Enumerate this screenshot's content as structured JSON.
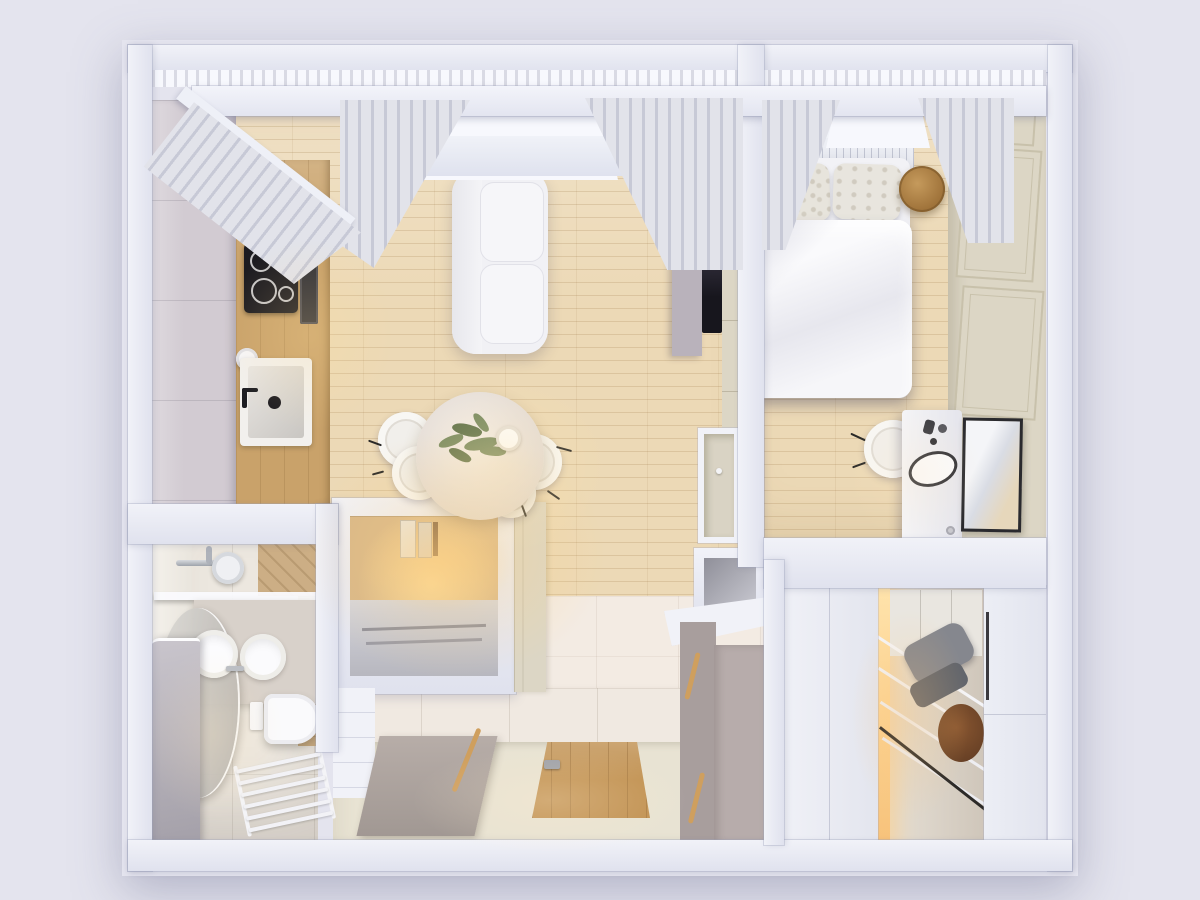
{
  "scene": {
    "type": "3d-floor-plan-top-down-render",
    "rooms": [
      {
        "name": "living-room-kitchen",
        "items": [
          "grey-kitchen-cabinets",
          "wood-counter",
          "cooktop",
          "oven",
          "kitchen-sink",
          "kettle",
          "paper-towel-roll",
          "sofa",
          "tv-console",
          "tv-screen",
          "dining-table",
          "dining-chairs",
          "plant-centerpiece",
          "desk-nook",
          "window-curtains"
        ]
      },
      {
        "name": "bedroom",
        "items": [
          "double-bed",
          "duvet",
          "pillows",
          "slatted-headboard",
          "round-bedside-table",
          "vanity-desk",
          "vanity-chair",
          "oval-table-mirror",
          "wall-mirror",
          "paneled-wardrobe-wall",
          "window-curtains"
        ]
      },
      {
        "name": "bathroom",
        "items": [
          "shower-mixer",
          "shower-shelf",
          "glass-screen",
          "round-basin",
          "leaning-round-mirror",
          "wall-hung-toilet",
          "flush-plate",
          "towel-ladder-radiator",
          "glass-panel"
        ]
      },
      {
        "name": "hallway",
        "items": [
          "entrance-wood-door",
          "grey-bathroom-door",
          "tiled-wall",
          "hall-cabinet",
          "wall-niche"
        ]
      },
      {
        "name": "walk-in-closet",
        "items": [
          "sliding-door-left",
          "sliding-door-right",
          "open-shelving",
          "folded-clothes",
          "round-wood-box",
          "hanging-rail",
          "led-light-strip"
        ]
      }
    ]
  },
  "palette": {
    "bg": "#e4e4ee",
    "wallhi": "#f1f2f8",
    "walllo": "#e0e2ee",
    "beam": "#eef0f7",
    "winlight": "#f7f8fd",
    "curtain": "#e2e3ea",
    "curtaindark": "#c7c9d6",
    "woodfloor": "#ecd9b6",
    "woodcab": "#c9a26a",
    "wooddark": "#8a5731",
    "wooddoor": "#c09050",
    "woodtable": "#b5884e",
    "greycab": "#d2cbd2",
    "taupe": "#b7acab",
    "taupedark": "#a89e9d",
    "cream": "#dcd6c5",
    "creamline": "#c8c1ab",
    "bathtile": "#ece7df",
    "halltile": "#e8e3d3",
    "hallwall": "#f0e9e1",
    "livtile": "#f3ebe3",
    "white": "#f2f2f6",
    "dark": "#1c1b20",
    "screen": "#211f29",
    "chrome": "#b9bdc4",
    "plant": "#74885f",
    "plantdark": "#5c7049",
    "cloth": "#85878e",
    "clothdark": "#62656c",
    "rail": "#2c2a28",
    "glass": "#b5b1b9"
  }
}
